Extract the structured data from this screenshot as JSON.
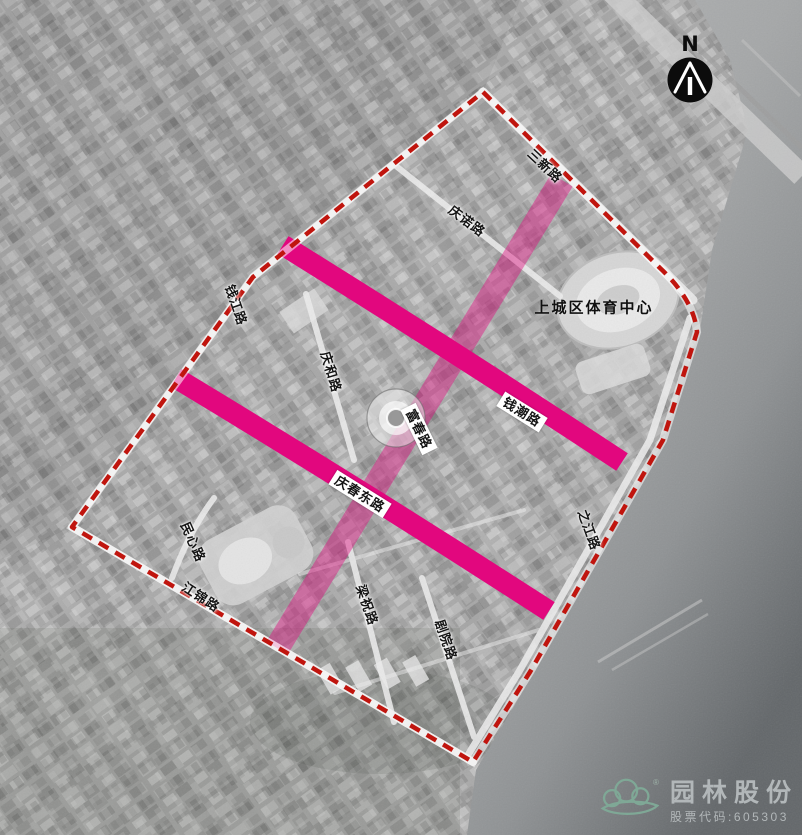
{
  "map": {
    "type": "satellite-plan",
    "description": "grayscale aerial photo with planning overlay",
    "poi": {
      "sports_center": "上城区体育中心"
    },
    "roads": [
      {
        "id": "sanxin",
        "name": "三新路"
      },
      {
        "id": "qingnuo",
        "name": "庆诺路"
      },
      {
        "id": "qianjiang",
        "name": "钱江路"
      },
      {
        "id": "qinghe",
        "name": "庆和路"
      },
      {
        "id": "fuchun",
        "name": "富春路"
      },
      {
        "id": "qianchao",
        "name": "钱潮路"
      },
      {
        "id": "qingchundong",
        "name": "庆春东路"
      },
      {
        "id": "zhijiang",
        "name": "之江路"
      },
      {
        "id": "minxin",
        "name": "民心路"
      },
      {
        "id": "jiangjin",
        "name": "江锦路"
      },
      {
        "id": "liangzhu",
        "name": "梁祝路"
      },
      {
        "id": "juyuan",
        "name": "剧院路"
      }
    ]
  },
  "north_arrow": {
    "label": "N"
  },
  "logo": {
    "company": "园林股份",
    "stock_code": "股票代码:605303",
    "registered_mark": "®"
  },
  "colors": {
    "road_highlight": "#e2077e",
    "road_highlight_soft": "rgba(226,7,126,0.42)",
    "boundary_dash_red": "#c0150e",
    "logo_green": "#7fa896",
    "logo_text_gray": "#b2b7b9",
    "water_gray": "#8f9294"
  }
}
